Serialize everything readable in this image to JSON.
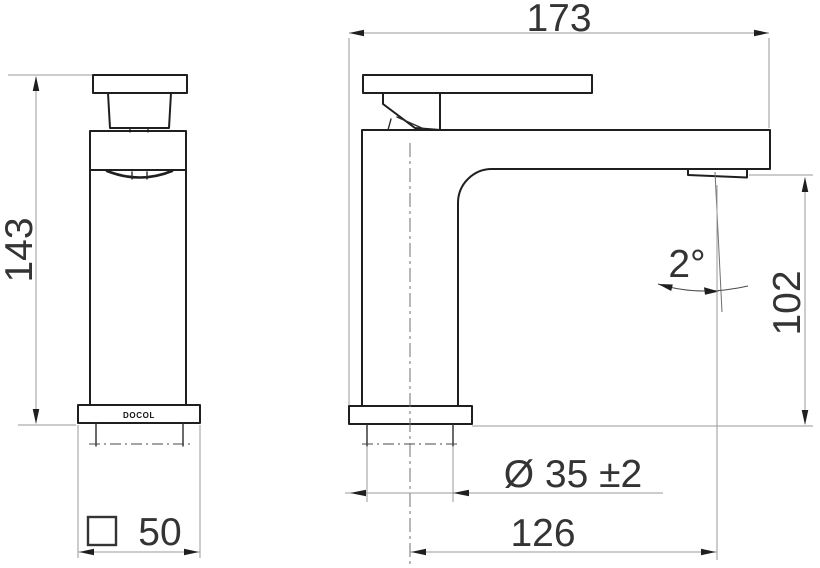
{
  "drawing": {
    "type": "faucet-dimensional-drawing",
    "brand": {
      "label": "DOCOL"
    },
    "dimensions": {
      "overall_width": "173",
      "overall_height": "143",
      "spout_angle": "2°",
      "outlet_height": "102",
      "shank_diameter": "Ø 35 ±2",
      "outlet_reach": "126",
      "base_square_value": "50",
      "base_square_symbol": "□"
    },
    "units_note_colors": {
      "line_color": "#1f1f1f",
      "dim_line_color": "#9a9a9a",
      "text_color": "#343434"
    }
  }
}
